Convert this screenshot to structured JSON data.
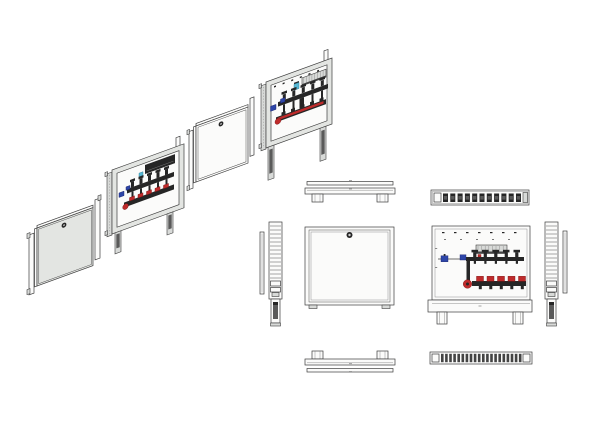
{
  "meta": {
    "description": "CAD multi-view technical drawing of an underfloor-heating manifold cabinet: exploded isometric sequence (door assembly, cabinet with manifold, white door, open cabinet with extended legs) plus orthographic top, front, side and bottom views",
    "background": "#ffffff"
  },
  "colors": {
    "bg": "#ffffff",
    "line": "#3d3d3d",
    "line_soft": "#909090",
    "panel": "#e3e5e2",
    "panel_bright": "#fbfbfa",
    "metal": "#d8dad8",
    "dark": "#262626",
    "leg_dark": "#5a5a5a",
    "red": "#bf2b2b",
    "blue": "#2e46a8",
    "cyan": "#58b8d4"
  },
  "counts": {
    "loops": 5,
    "rungs": 14,
    "slots": 20,
    "top_components": 11,
    "screws_top": 7,
    "screws_mid": 5,
    "hatch": 8,
    "pair": 2,
    "iso_screws": 6
  },
  "views": {
    "iso_door_assembly": {
      "name": "isometric-door-panel-with-frame",
      "lock": true
    },
    "iso_cabinet_manifold": {
      "name": "isometric-cabinet-with-manifold-and-legs"
    },
    "iso_door_white": {
      "name": "isometric-white-door-with-frame",
      "lock": true
    },
    "iso_cabinet_open": {
      "name": "isometric-open-cabinet-manifold-extended-legs"
    },
    "ortho_top_closed": {
      "name": "top-view-cabinet-closed"
    },
    "ortho_side_left": {
      "name": "left-side-view-rail-and-leg"
    },
    "ortho_front_closed": {
      "name": "front-view-door-closed",
      "lock": true
    },
    "ortho_top_manifold": {
      "name": "top-view-cabinet-with-manifold"
    },
    "ortho_front_open": {
      "name": "front-view-open-cabinet-with-manifold",
      "loops": 5
    },
    "ortho_side_right": {
      "name": "right-side-view-rail-and-leg"
    },
    "ortho_bottom_closed": {
      "name": "bottom-view-cabinet-closed"
    },
    "ortho_bottom_manifold": {
      "name": "bottom-view-pipe-outlet-slots",
      "slots": 20
    }
  },
  "manifold": {
    "loops": 5,
    "upper_row": "dark-actuator-valves",
    "lower_row": "red-flowmeter-caps",
    "shutoff_valves": "blue",
    "junction_box": true,
    "pump_valve": "red"
  }
}
